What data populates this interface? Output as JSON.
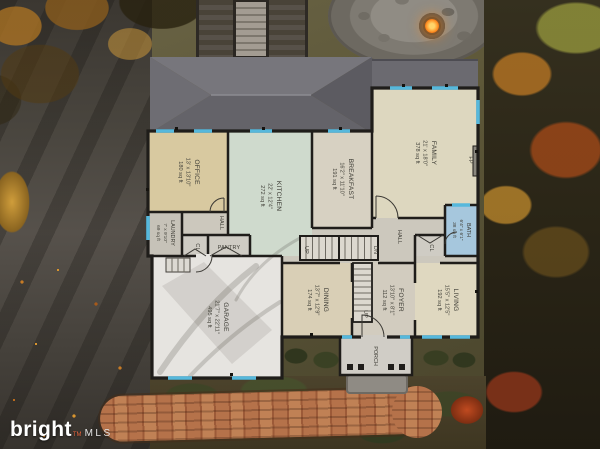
{
  "logo": {
    "brand": "bright",
    "tm": "TM",
    "mls": "MLS"
  },
  "floorplan": {
    "rooms": [
      {
        "id": "office",
        "name": "OFFICE",
        "dims": "13' x 13'10\"",
        "area": "180 sq ft"
      },
      {
        "id": "kitchen",
        "name": "KITCHEN",
        "dims": "22' x 12'4\"",
        "area": "272 sq ft"
      },
      {
        "id": "breakfast",
        "name": "BREAKFAST",
        "dims": "16'2\" x 11'10\"",
        "area": "191 sq ft"
      },
      {
        "id": "family",
        "name": "FAMILY",
        "dims": "21' x 18'0\"",
        "area": "378 sq ft"
      },
      {
        "id": "laundry",
        "name": "LAUNDRY",
        "dims": "7' x 9'10\"",
        "area": "69 sq ft"
      },
      {
        "id": "bath",
        "name": "BATH",
        "dims": "6'4\" x 6'1\"",
        "area": "38 sq ft"
      },
      {
        "id": "garage",
        "name": "GARAGE",
        "dims": "21'7\" x 22'11\"",
        "area": "495 sq ft"
      },
      {
        "id": "dining",
        "name": "DINING",
        "dims": "13'7\" x 12'9\"",
        "area": "174 sq ft"
      },
      {
        "id": "foyer",
        "name": "FOYER",
        "dims": "13'10\" x 8'1\"",
        "area": "112 sq ft"
      },
      {
        "id": "living",
        "name": "LIVING",
        "dims": "15'5\" x 12'5\"",
        "area": "192 sq ft"
      },
      {
        "id": "porch",
        "name": "PORCH"
      }
    ],
    "labels": {
      "hall_left": "HALL",
      "hall_right": "HALL",
      "pantry": "PANTRY",
      "closet_left": "CL",
      "closet_right": "CL",
      "up_main": "UP",
      "up_foyer": "UP",
      "down": "DN",
      "fireplace": "FP"
    },
    "colors": {
      "wall": "#1f1d1a",
      "window": "#56b8dc",
      "bath_fill": "#a6c7dd",
      "office_fill": "#d8c9a0",
      "kitchen_fill": "#cfdacd",
      "family_fill": "#ddd7bf",
      "garage_fill": "#e6e4e0",
      "brick_path": "#a9613a",
      "fire_glow": "#ff9a2d"
    }
  }
}
